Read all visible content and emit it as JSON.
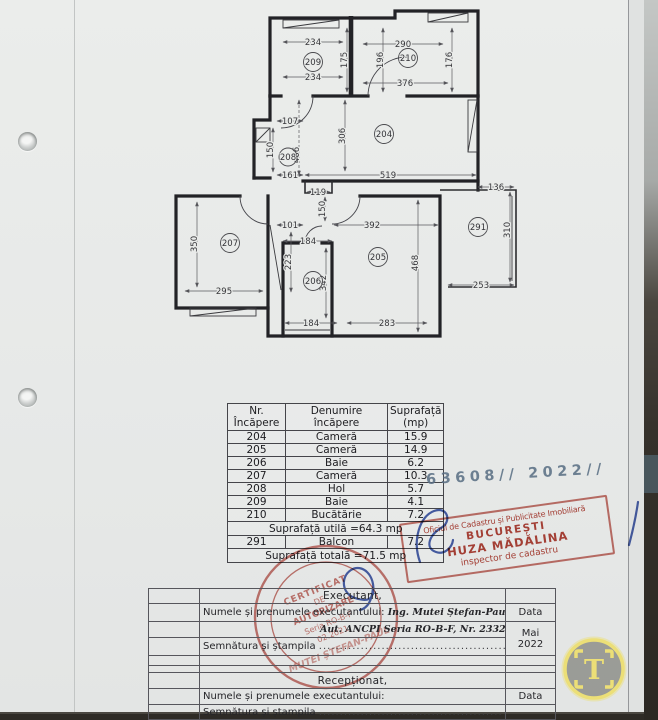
{
  "document": {
    "registration_number": "63608// 2022//"
  },
  "plan": {
    "rooms": {
      "r204": "204",
      "r205": "205",
      "r206": "206",
      "r207": "207",
      "r208": "208",
      "r209": "209",
      "r210": "210",
      "r291": "291"
    },
    "dims": {
      "d01": "234",
      "d02": "290",
      "d03": "175",
      "d04": "196",
      "d05": "176",
      "d06": "234",
      "d07": "376",
      "d08": "107",
      "d09": "306",
      "d10": "150",
      "d11": "466",
      "d12": "161",
      "d13": "519",
      "d14": "136",
      "d15": "119",
      "d16": "150",
      "d17": "101",
      "d18": "392",
      "d19": "310",
      "d20": "350",
      "d21": "184",
      "d22": "223",
      "d23": "342",
      "d24": "468",
      "d25": "253",
      "d26": "295",
      "d27": "184",
      "d28": "283"
    }
  },
  "room_table": {
    "header": {
      "col1_line1": "Nr.",
      "col1_line2": "Încăpere",
      "col2": "Denumire încăpere",
      "col3_line1": "Suprafață",
      "col3_line2": "(mp)"
    },
    "rows": [
      {
        "nr": "204",
        "name": "Cameră",
        "area": "15.9"
      },
      {
        "nr": "205",
        "name": "Cameră",
        "area": "14.9"
      },
      {
        "nr": "206",
        "name": "Baie",
        "area": "6.2"
      },
      {
        "nr": "207",
        "name": "Cameră",
        "area": "10.3"
      },
      {
        "nr": "208",
        "name": "Hol",
        "area": "5.7"
      },
      {
        "nr": "209",
        "name": "Baie",
        "area": "4.1"
      },
      {
        "nr": "210",
        "name": "Bucătărie",
        "area": "7.2"
      }
    ],
    "useful_area_row": "Suprafață utilă =64.3 mp",
    "balcony_row": {
      "nr": "291",
      "name": "Balcon",
      "area": "7.2"
    },
    "total_area_row": "Suprafață totală =71.5 mp"
  },
  "stamps": {
    "rect_stamp": {
      "line1": "Oficiul de Cadastru și Publicitate Imobiliară",
      "line2": "BUCUREȘTI",
      "line3": "HUZA MĂDĂLINA",
      "line4": "inspector de cadastru"
    },
    "round_stamp": {
      "line1": "CERTIFICAT",
      "line2": "DE",
      "line3": "AUTORIZARE",
      "line4": "Seria RO-B-F",
      "line5": "02.2021",
      "name": "MUTEI ȘTEFAN-PAUL"
    }
  },
  "executant": {
    "title": "Executant,",
    "name_label": "Numele și prenumele executantului:",
    "name_value": "Ing. Mutei Ștefan-Paul",
    "authorization": "Aut. ANCPI Seria RO-B-F, Nr. 2332",
    "signature_label": "Semnătura și ștampila",
    "signature_dots": "...............................................",
    "date_label": "Data",
    "date_month": "Mai",
    "date_year": "2022"
  },
  "reception": {
    "title": "Recepționat,",
    "name_label": "Numele și prenumele executantului:",
    "signature_label": "Semnătura și ștampila",
    "signature_dots": "............................................",
    "date_label": "Data"
  },
  "watermark": {
    "letter": "T"
  },
  "colors": {
    "stamp_red": "#b03529",
    "pen_blue": "#2b46a0",
    "handwriting_blue": "#5c7186",
    "watermark_yellow": "#ecdf77",
    "paper": "#e8eae9"
  }
}
